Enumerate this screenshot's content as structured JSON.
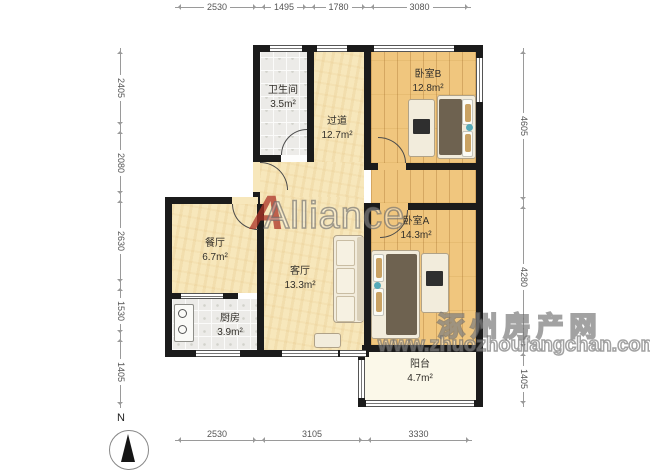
{
  "dims": {
    "top": [
      "2530",
      "1495",
      "1780",
      "3080"
    ],
    "bottom": [
      "2530",
      "3105",
      "3330"
    ],
    "left": [
      "2405",
      "2080",
      "2630",
      "1530",
      "1405"
    ],
    "right": [
      "4605",
      "4280",
      "1405"
    ]
  },
  "rooms": {
    "bathroom": {
      "name": "卫生间",
      "area": "3.5m²"
    },
    "hallway": {
      "name": "过道",
      "area": "12.7m²"
    },
    "bedroomB": {
      "name": "卧室B",
      "area": "12.8m²"
    },
    "bedroomA": {
      "name": "卧室A",
      "area": "14.3m²"
    },
    "dining": {
      "name": "餐厅",
      "area": "6.7m²"
    },
    "living": {
      "name": "客厅",
      "area": "13.3m²"
    },
    "kitchen": {
      "name": "厨房",
      "area": "3.9m²"
    },
    "balcony": {
      "name": "阳台",
      "area": "4.7m²"
    }
  },
  "watermarks": {
    "alliance_logo": "A",
    "alliance_text": "Alliance",
    "site_name": "涿州房产网",
    "site_url": "www.zhuozhoufangchan.com"
  },
  "compass": {
    "label": "N"
  },
  "colors": {
    "wall": "#1b1b1b",
    "bedroom_floor": "#f0c67e",
    "living_floor": "#f7e7bb",
    "tile_floor": "#ecebe8",
    "balcony_floor": "#fbf8e9",
    "logo_red": "#ad3428",
    "dimension_gray": "#9a9a9a"
  }
}
